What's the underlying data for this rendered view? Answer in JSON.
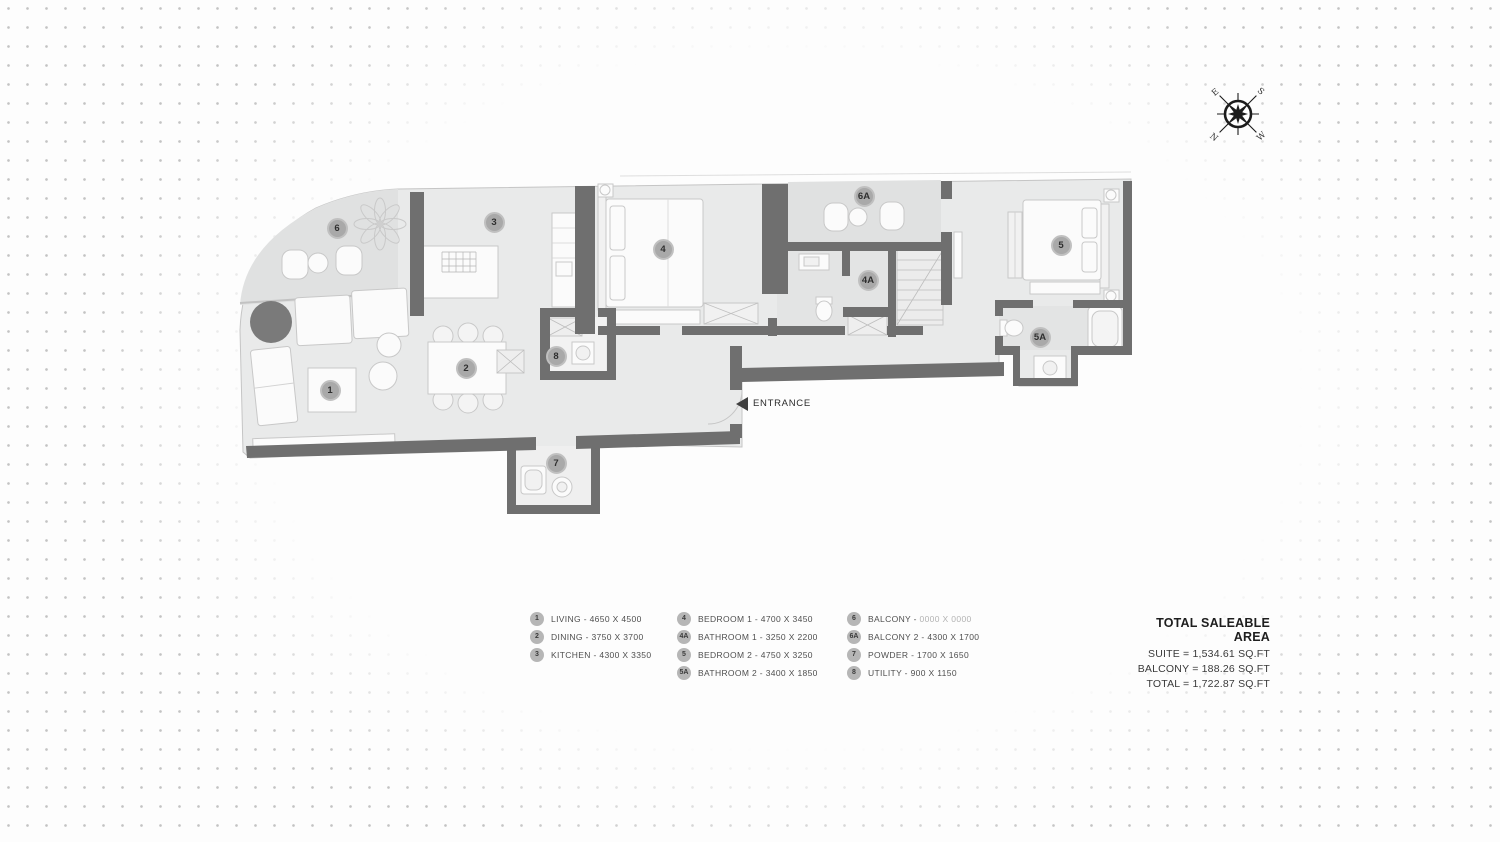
{
  "plan": {
    "entrance": {
      "label": "ENTRANCE"
    },
    "markers": [
      {
        "id": "1"
      },
      {
        "id": "2"
      },
      {
        "id": "3"
      },
      {
        "id": "4"
      },
      {
        "id": "4A"
      },
      {
        "id": "5"
      },
      {
        "id": "5A"
      },
      {
        "id": "6"
      },
      {
        "id": "6A"
      },
      {
        "id": "7"
      },
      {
        "id": "8"
      }
    ]
  },
  "compass": {
    "n": "N",
    "e": "E",
    "s": "S",
    "w": "W"
  },
  "legend": {
    "separator": " - ",
    "columns": [
      {
        "items": [
          {
            "marker": "1",
            "name": "LIVING",
            "dims": "4650 X 4500"
          },
          {
            "marker": "2",
            "name": "DINING",
            "dims": "3750 X 3700"
          },
          {
            "marker": "3",
            "name": "KITCHEN",
            "dims": "4300 X 3350"
          }
        ]
      },
      {
        "items": [
          {
            "marker": "4",
            "name": "BEDROOM 1",
            "dims": "4700 X 3450"
          },
          {
            "marker": "4A",
            "name": "BATHROOM 1",
            "dims": "3250 X 2200"
          },
          {
            "marker": "5",
            "name": "BEDROOM 2",
            "dims": "4750 X 3250"
          },
          {
            "marker": "5A",
            "name": "BATHROOM 2",
            "dims": "3400 X 1850"
          }
        ]
      },
      {
        "items": [
          {
            "marker": "6",
            "name": "BALCONY",
            "dims": "0000 X 0000"
          },
          {
            "marker": "6A",
            "name": "BALCONY 2",
            "dims": "4300 X 1700"
          },
          {
            "marker": "7",
            "name": "POWDER",
            "dims": "1700 X 1650"
          },
          {
            "marker": "8",
            "name": "UTILITY",
            "dims": "900 X 1150"
          }
        ]
      }
    ]
  },
  "totals": {
    "title": "TOTAL SALEABLE AREA",
    "rows": [
      "SUITE  =  1,534.61  SQ.FT",
      "BALCONY =  188.26  SQ.FT",
      "TOTAL =  1,722.87  SQ.FT"
    ]
  },
  "colors": {
    "wall": "#6f6f6f",
    "floor": "#e9eaea",
    "balcony_floor": "#e0e1e1",
    "marker_bg": "#a9a9a9",
    "dot_grid": "#c3c3c3"
  }
}
